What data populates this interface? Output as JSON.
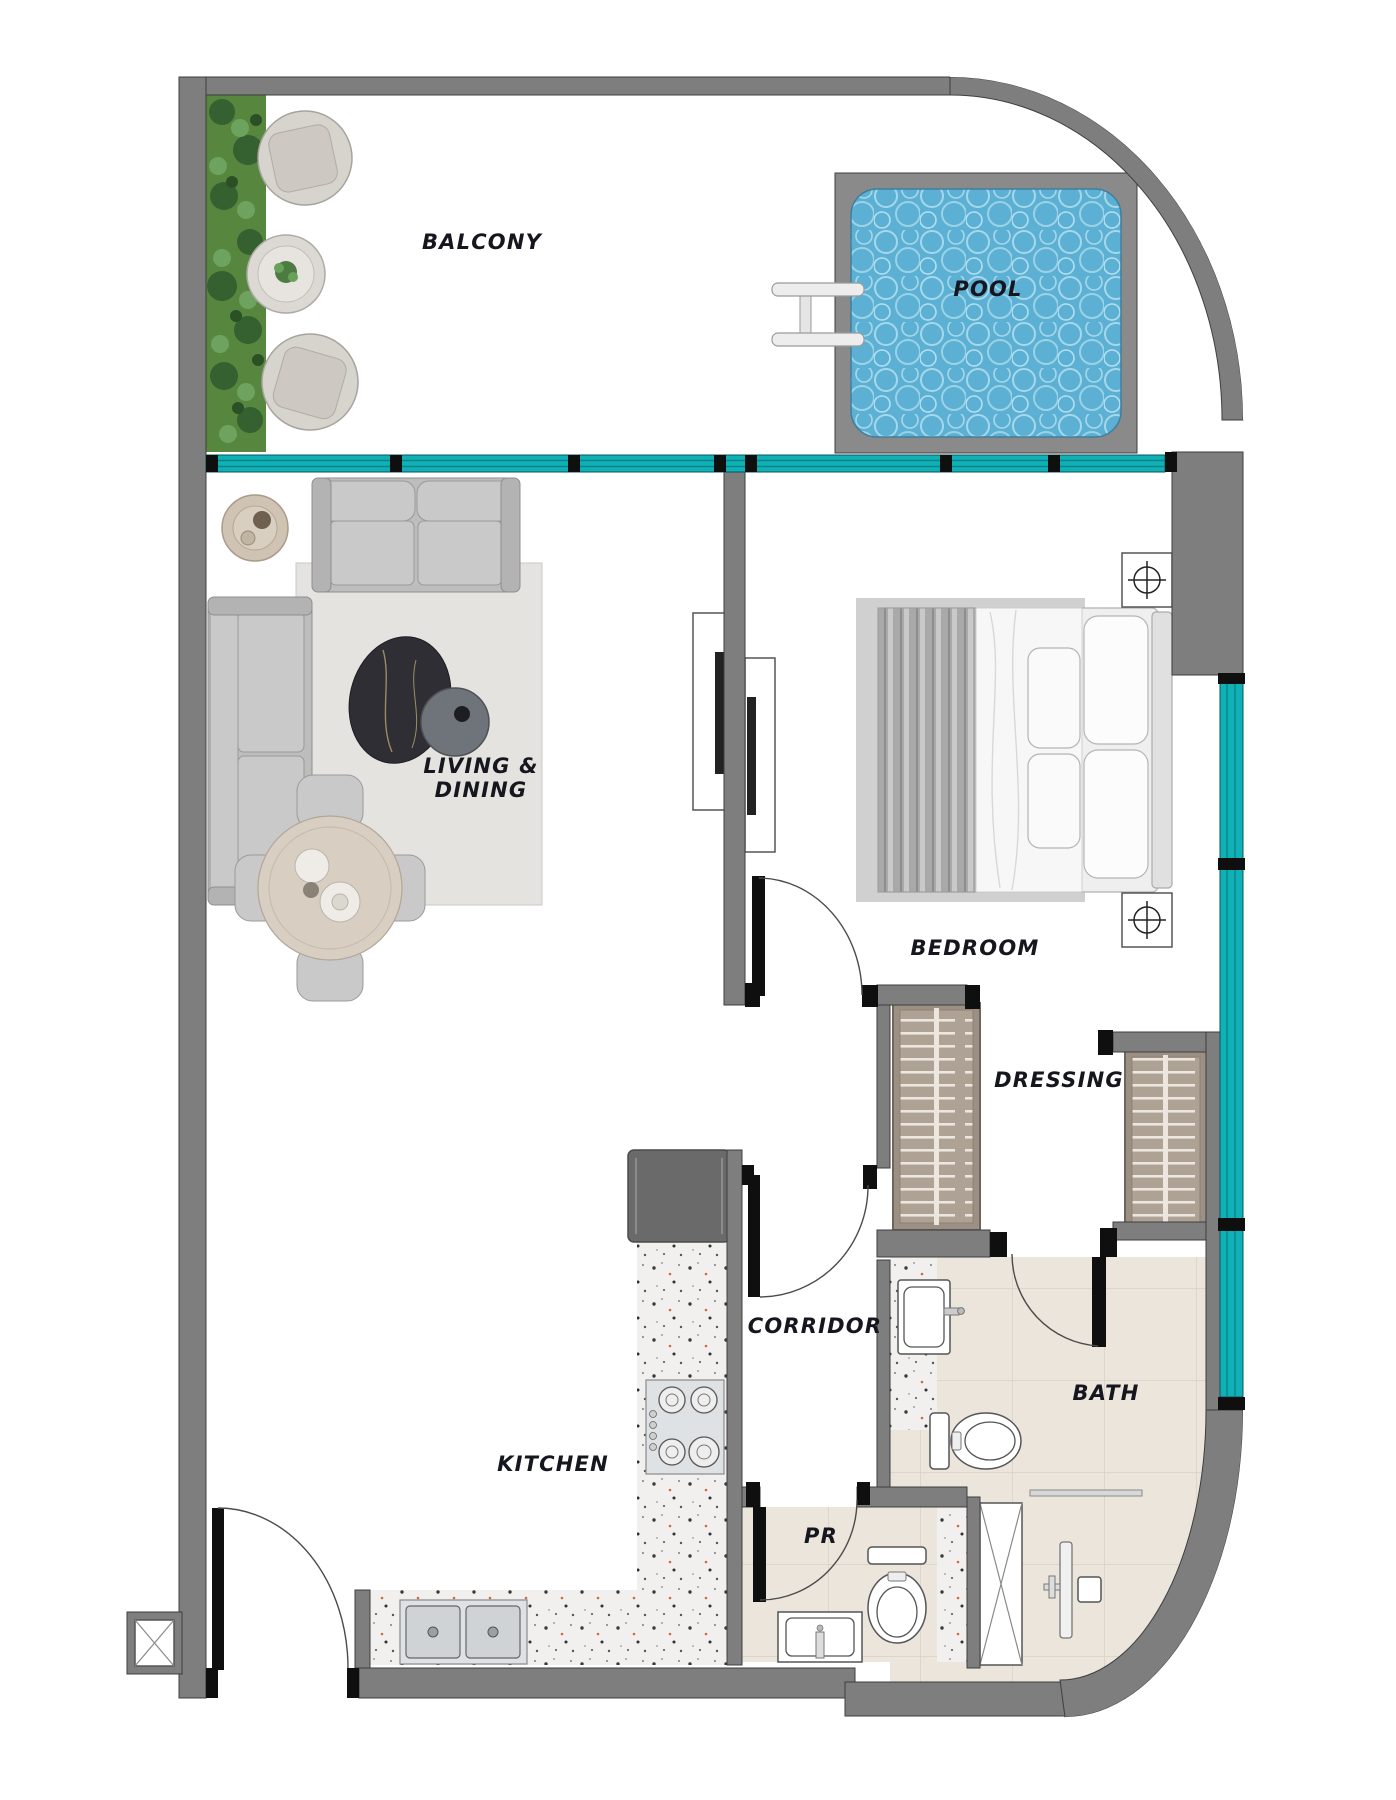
{
  "rooms": {
    "balcony": {
      "label": "BALCONY"
    },
    "pool": {
      "label": "POOL"
    },
    "living_dining": {
      "line1": "LIVING &",
      "line2": "DINING"
    },
    "bedroom": {
      "label": "BEDROOM"
    },
    "dressing": {
      "label": "DRESSING"
    },
    "corridor": {
      "label": "CORRIDOR"
    },
    "kitchen": {
      "label": "KITCHEN"
    },
    "bath": {
      "label": "BATH"
    },
    "powder_room": {
      "label": "PR"
    }
  },
  "colors": {
    "wall": "#7e7e7e",
    "wall_outline": "#3e3e3e",
    "pool_frame": "#8a8a8a",
    "window_glass": "#0fb0b6",
    "pool_water": "#5cb0d4",
    "tile_beige": "#ebe5db",
    "terrazzo_base": "#f1f0ee",
    "rug": "#e4e3e0",
    "bed_rug": "#d0d0d0",
    "wardrobe": "#9b9083",
    "plant_green": "#57863f",
    "label_text": "#16161e",
    "door_black": "#0f0f0f"
  },
  "fixtures": [
    "balcony planter",
    "lounge chair",
    "lounge chair",
    "balcony side table",
    "plunge pool",
    "pool ladder",
    "two-seat sofa",
    "corner sofa",
    "stone coffee table",
    "round side table",
    "dining table with four chairs",
    "TV unit living side",
    "TV unit bedroom side",
    "double bed",
    "nightstand lamp",
    "nightstand lamp",
    "wardrobe",
    "wardrobe",
    "refrigerator",
    "gas hob",
    "double kitchen sink",
    "washbasin vanity",
    "toilet",
    "toilet",
    "powder-room basin",
    "shower set",
    "towel rail",
    "service shaft",
    "service shaft"
  ]
}
